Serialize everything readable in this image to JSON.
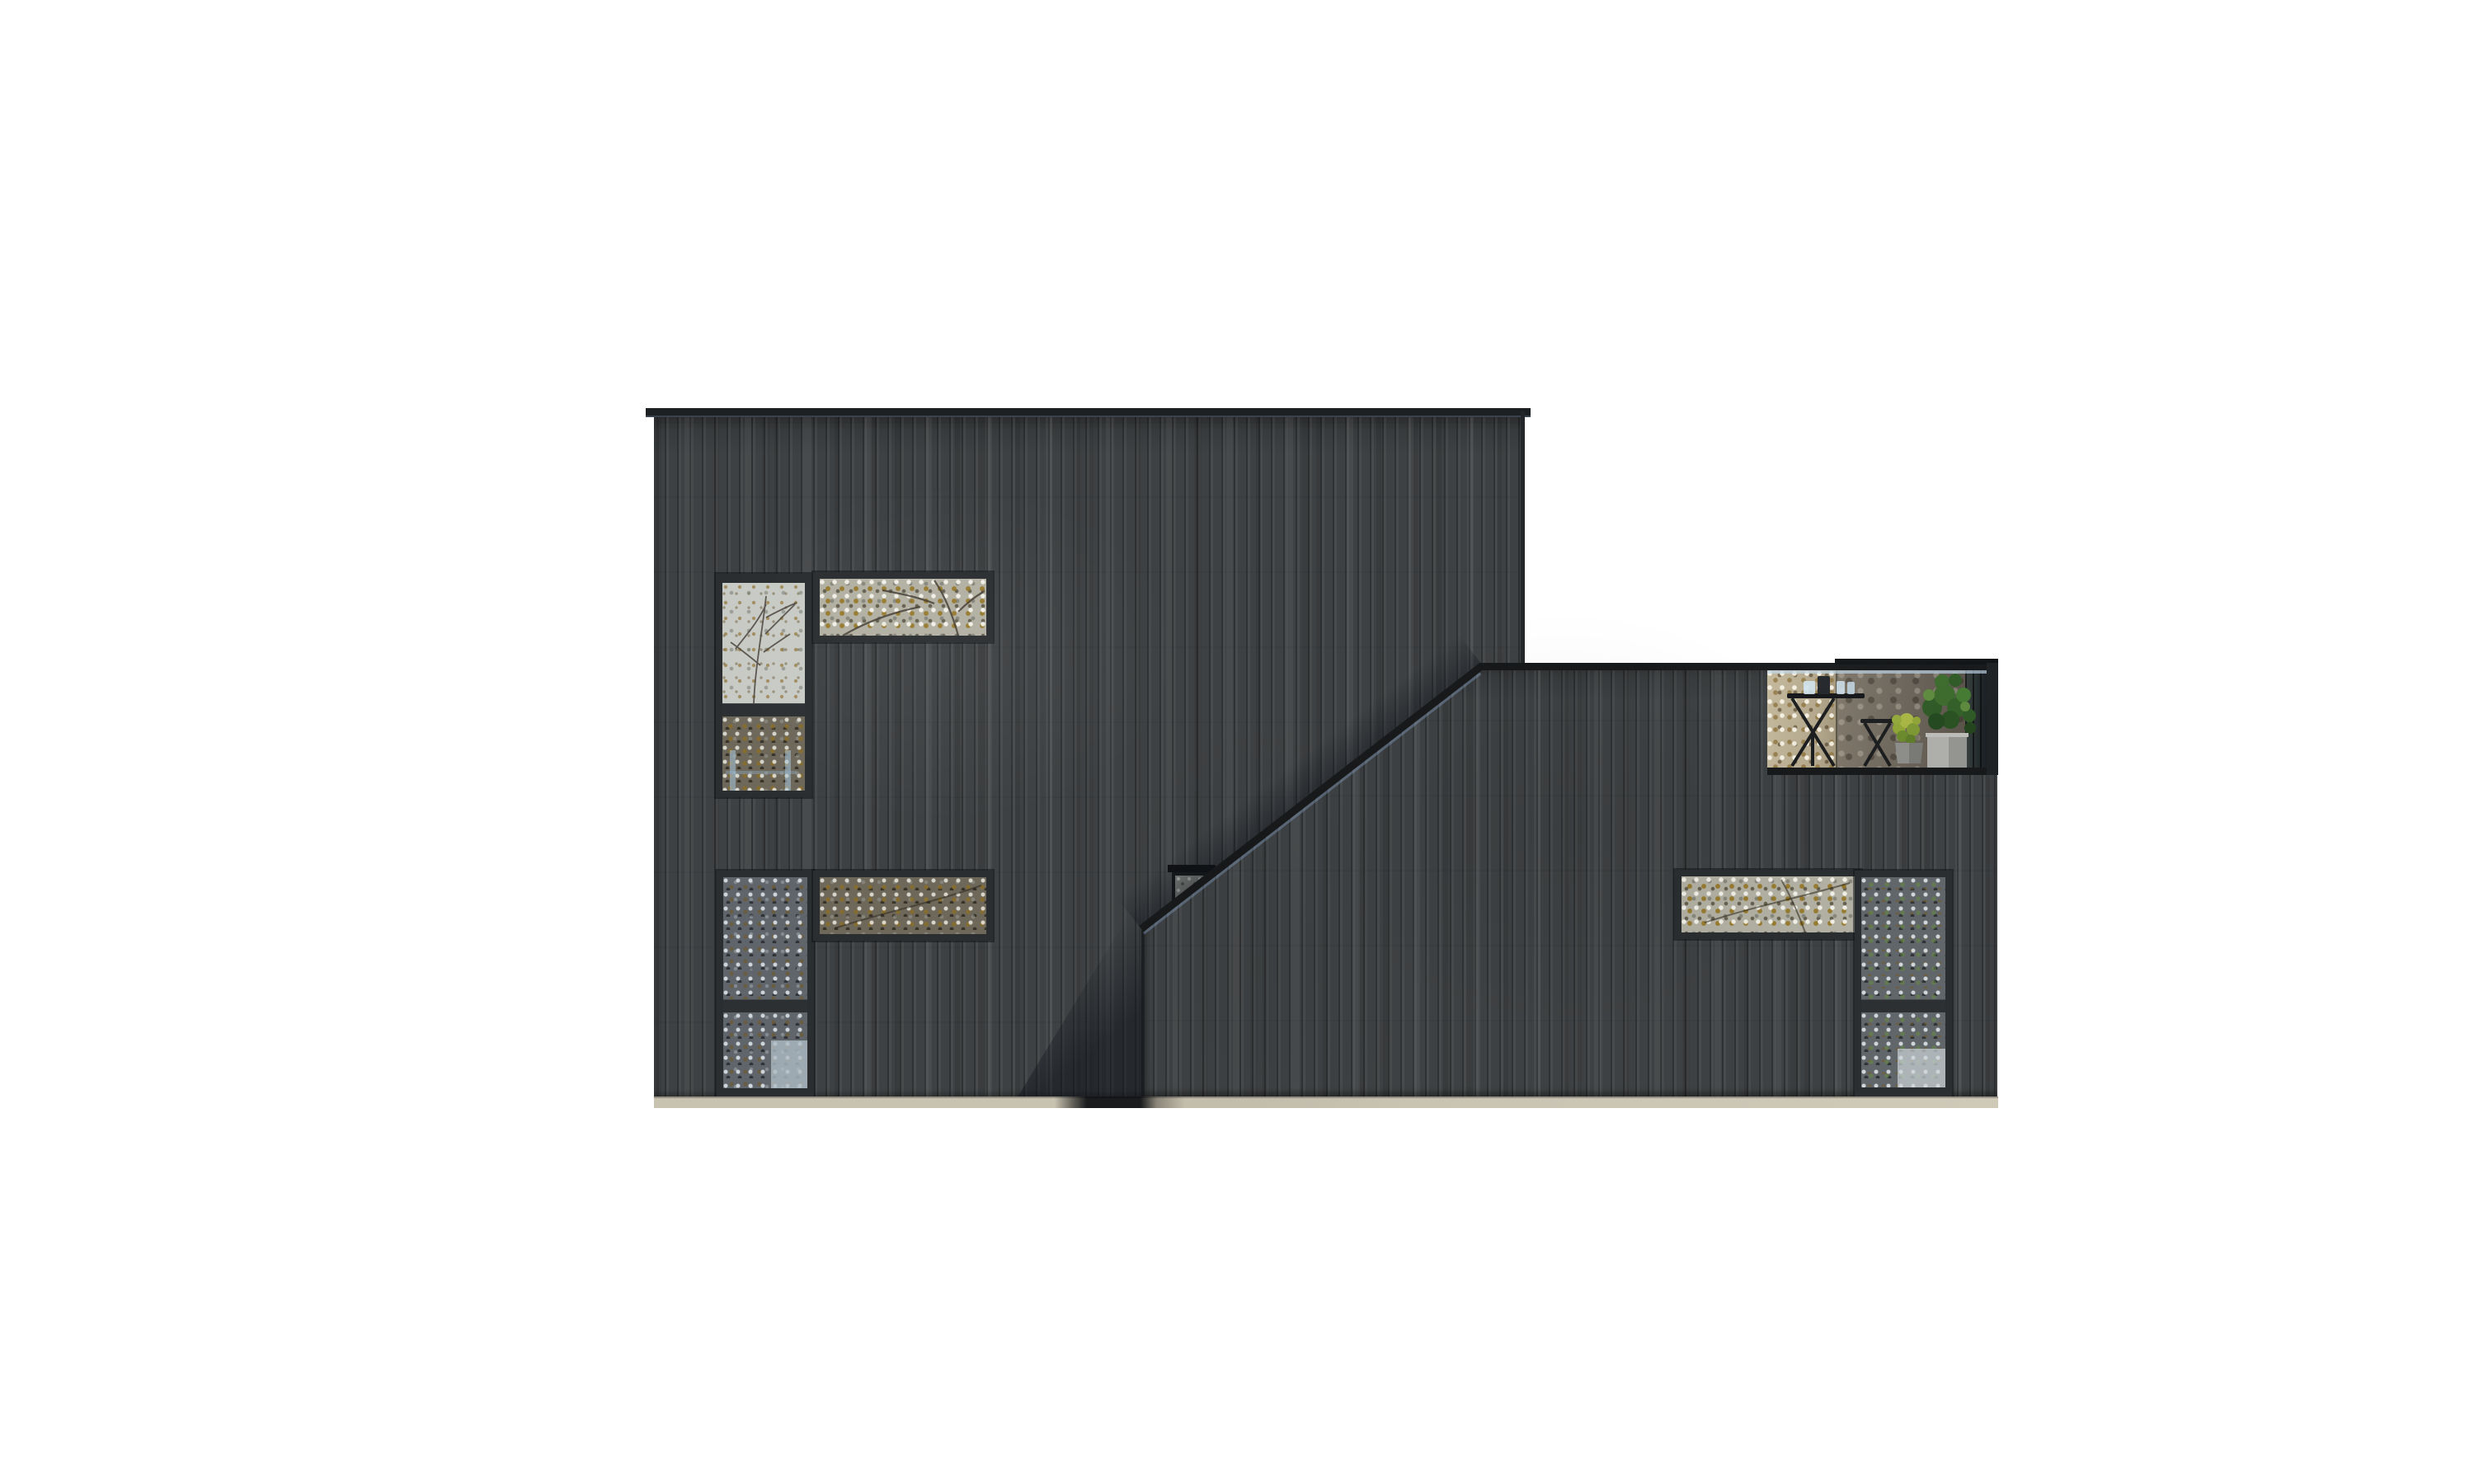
{
  "scene": {
    "title": "Architectural elevation rendering of a charred-black timber house on a white background",
    "background_color": "#ffffff",
    "materials": {
      "cladding": "vertical black-stained timber planks",
      "cladding_color": "#3e4143",
      "plank_joint_color": "#26282a",
      "trim_and_frame_color": "#2b2e31",
      "roof_cap_color": "#17191b",
      "flashing_highlight_color": "#8fb3d1",
      "plinth_color": "#c9c3b2",
      "plinth_shadow_color": "#17191b"
    },
    "left_block": {
      "label": "tall two-storey volume with flat roof",
      "windows": [
        {
          "id": "upper-tall",
          "label": "tall two-pane window reflecting sky and an autumn tree"
        },
        {
          "id": "upper-strip",
          "label": "horizontal strip window reflecting bright autumn foliage"
        },
        {
          "id": "lower-tall",
          "label": "tall two-pane window reflecting dense autumn foliage"
        },
        {
          "id": "lower-strip",
          "label": "horizontal strip window reflecting dense autumn foliage"
        },
        {
          "id": "stair-small",
          "label": "small square window partly hidden behind the sloping parapet"
        }
      ]
    },
    "right_block": {
      "label": "lower volume with rising mono-pitch parapet and roof terrace",
      "terrace": {
        "label": "roof terrace behind a glass balustrade",
        "items": [
          "folding bistro table with glasses",
          "folding stool",
          "small yellow-green potted shrub",
          "large green potted plant",
          "dark slatted screen at right corner"
        ],
        "glass_highlight_color": "#bed7eb",
        "plant_green": "#3c6b2d",
        "pot_gray": "#aeaeab"
      },
      "windows": [
        {
          "id": "right-strip",
          "label": "horizontal strip window reflecting autumn foliage"
        },
        {
          "id": "right-tall",
          "label": "tall two-pane window reflecting foliage with green leaves"
        }
      ]
    },
    "shadows": {
      "cast_shadow": "soft diagonal shadow cast by the low volume onto the tall volume near their junction"
    }
  }
}
